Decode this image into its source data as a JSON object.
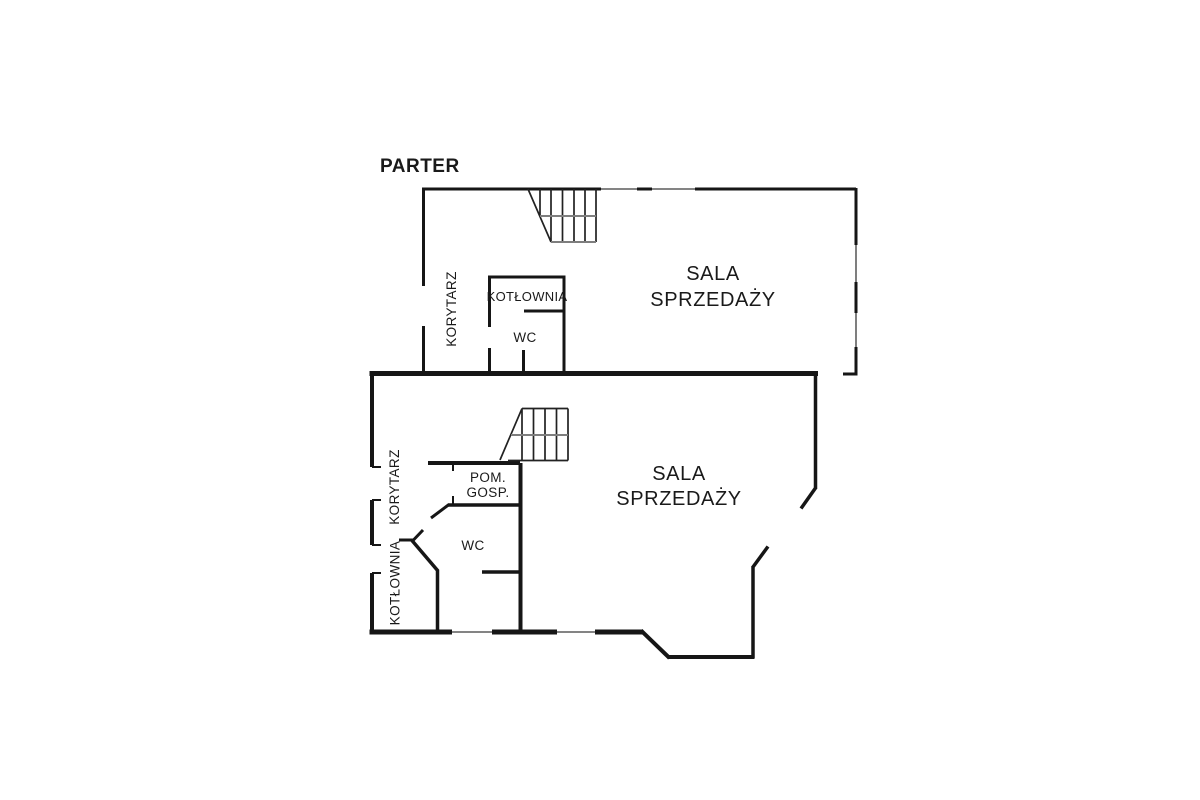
{
  "plan": {
    "title": "PARTER",
    "type": "floor-plan",
    "sections": [
      {
        "name": "upper-building-section",
        "rooms": [
          "KORYTARZ",
          "KOTŁOWNIA",
          "WC",
          "SALA SPRZEDAŻY"
        ],
        "features": [
          "stairs",
          "windows-top-wall",
          "windows-right-wall",
          "door-openings"
        ]
      },
      {
        "name": "lower-building-section",
        "rooms": [
          "KORYTARZ",
          "KOTŁOWNIA",
          "POM. GOSP.",
          "WC",
          "SALA SPRZEDAŻY"
        ],
        "features": [
          "stairs",
          "windows-bottom-wall",
          "angled-walls",
          "door-openings"
        ]
      }
    ]
  },
  "labels": {
    "title": "PARTER",
    "upper_korytarz": "KORYTARZ",
    "upper_kotlownia": "KOTŁOWNIA",
    "upper_wc": "WC",
    "upper_sala_line1": "SALA",
    "upper_sala_line2": "SPRZEDAŻY",
    "lower_korytarz": "KORYTARZ",
    "lower_kotlownia": "KOTŁOWNIA",
    "lower_pom_line1": "POM.",
    "lower_pom_line2": "GOSP.",
    "lower_wc": "WC",
    "lower_sala_line1": "SALA",
    "lower_sala_line2": "SPRZEDAŻY"
  },
  "colors": {
    "background": "#ffffff",
    "wall_line": "#161616",
    "stair_secondary_line": "#7e7e7e",
    "text": "#1a1a1a"
  }
}
